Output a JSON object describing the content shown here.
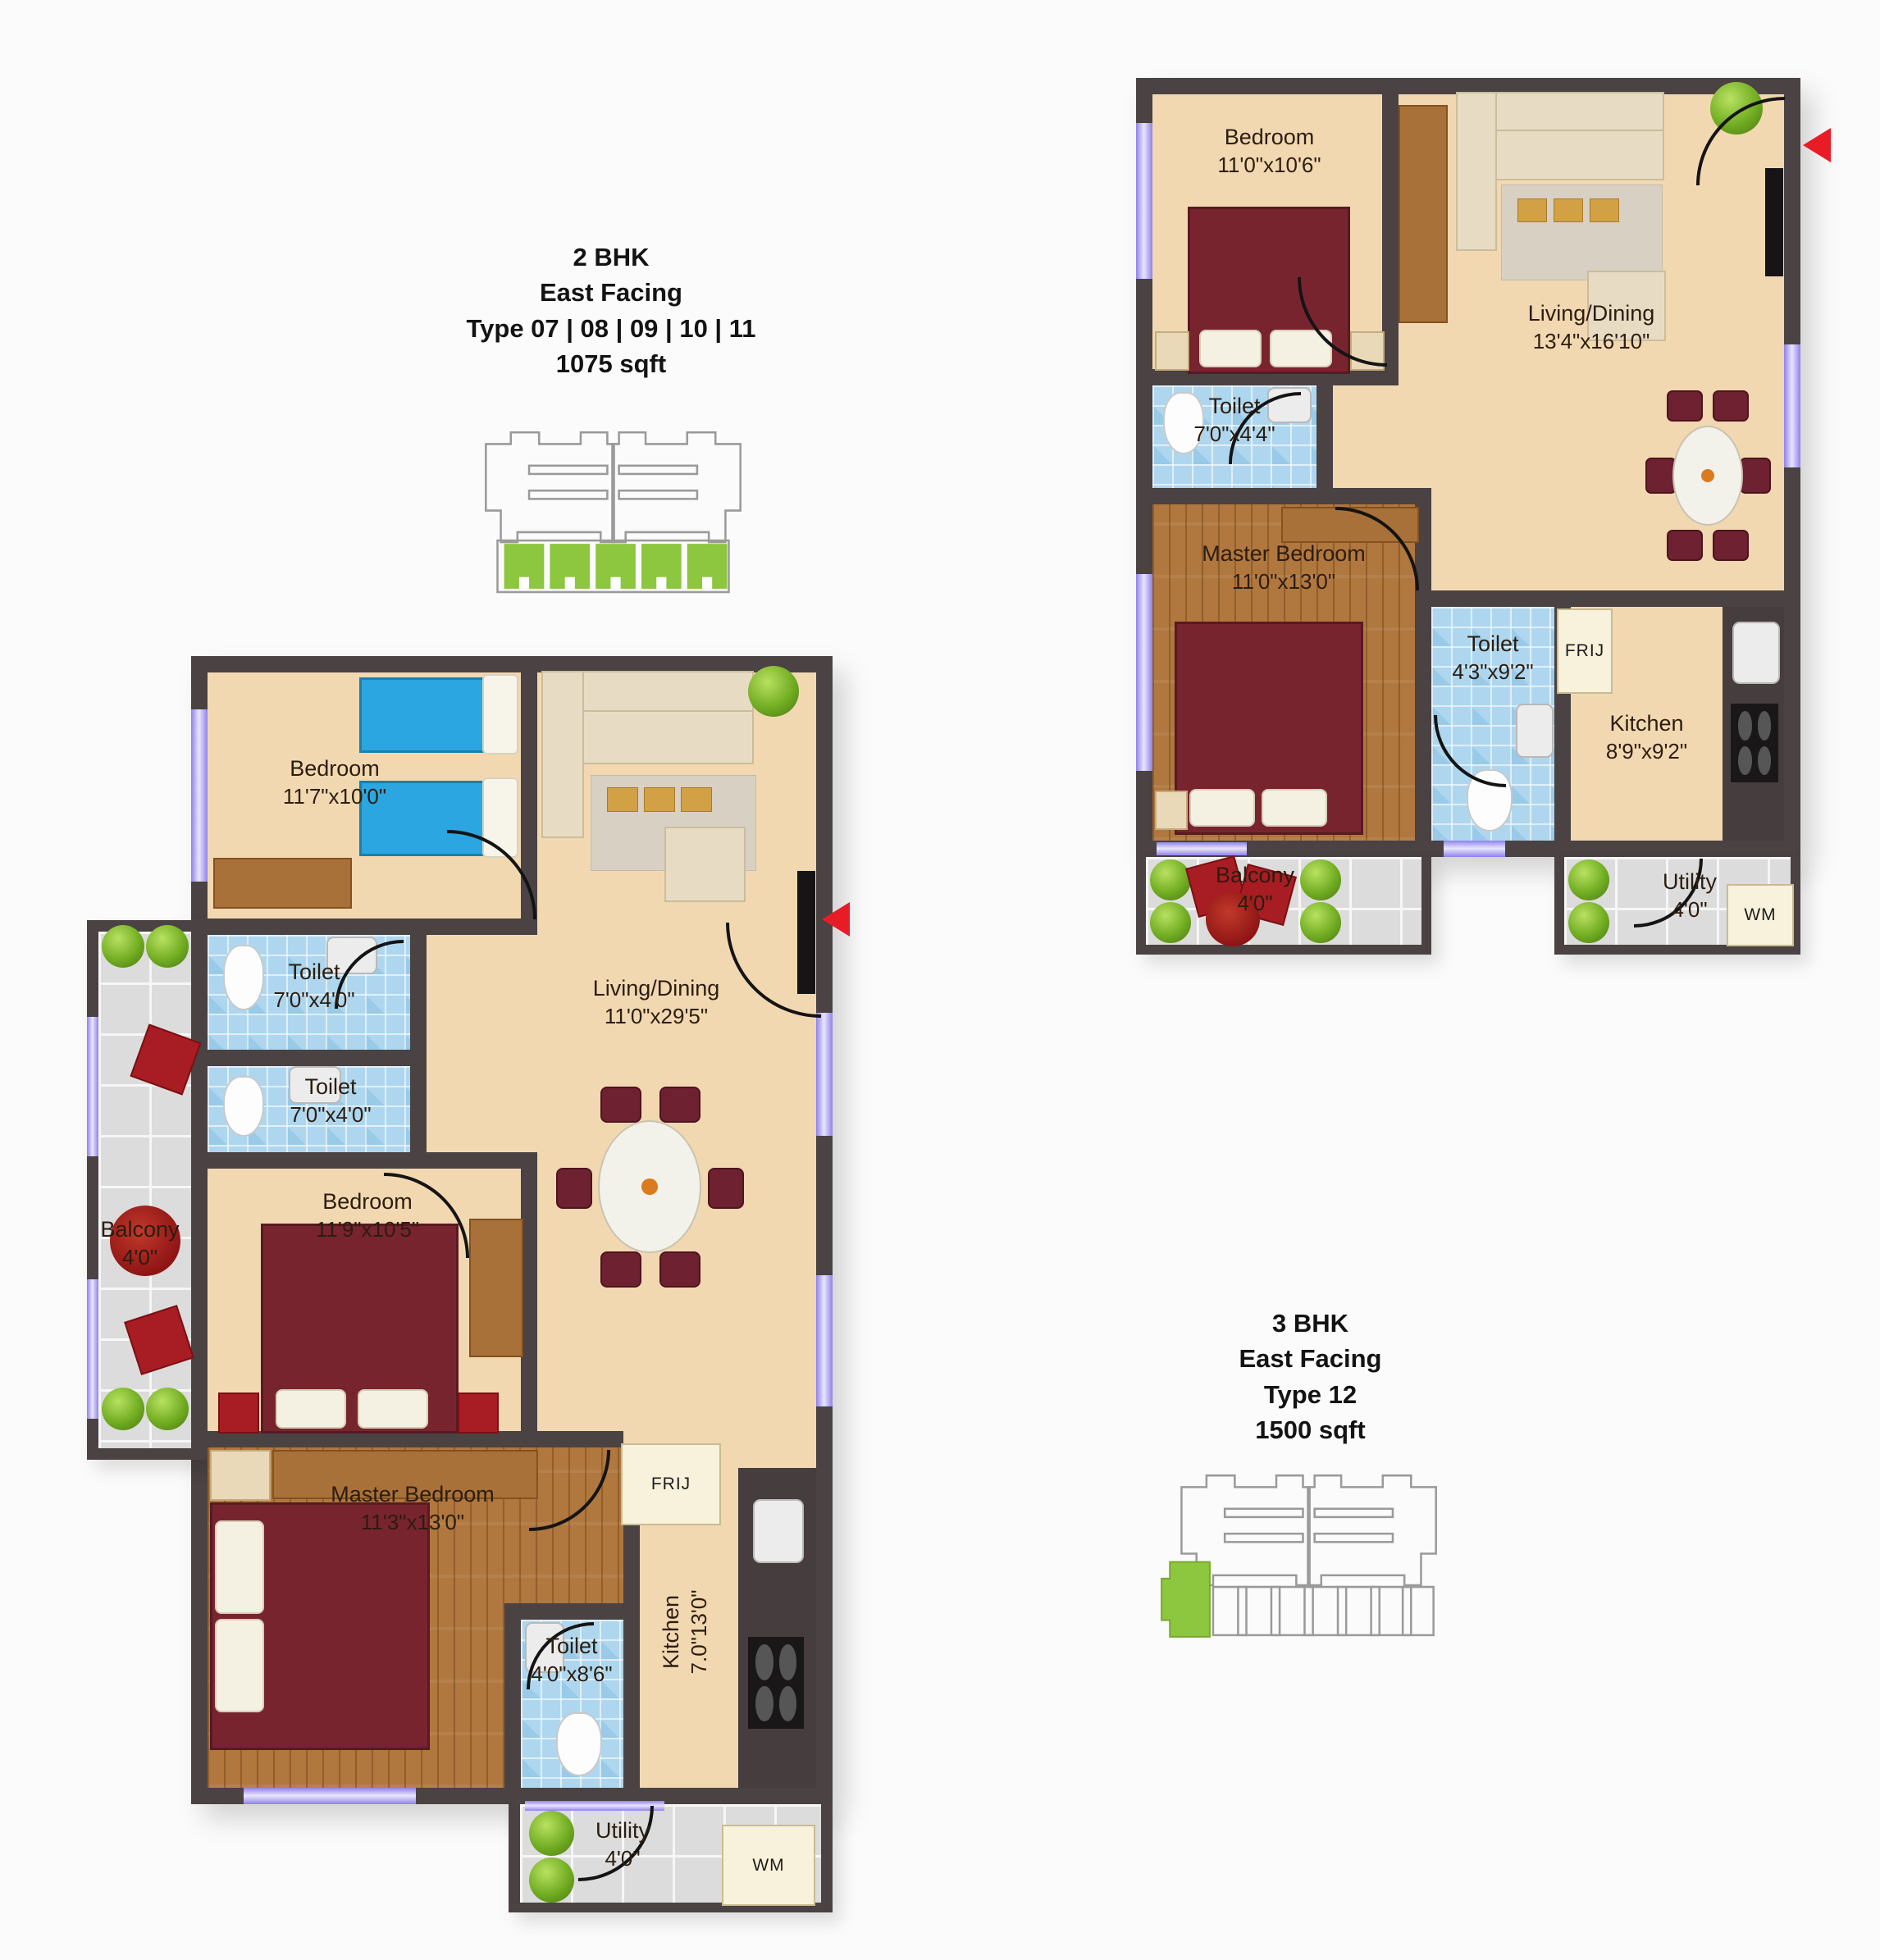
{
  "colors": {
    "wall": "#4a4243",
    "floor_cream": "#f2d8b1",
    "tile_blue": "#aed7ef",
    "wood": "#b0773e",
    "balcony_tile": "#dcdcdc",
    "keyplan_green": "#8dc63f",
    "arrow_red": "#e81c26",
    "window_lavender": "#8f82e8",
    "bed_maroon": "#78242f",
    "bed_blue": "#2ba6e0"
  },
  "left_plan": {
    "title": {
      "bhk": "2 BHK",
      "facing": "East Facing",
      "type": "Type 07 | 08 | 09 | 10 | 11",
      "area": "1075 sqft"
    },
    "rooms": {
      "bedroom1": {
        "name": "Bedroom",
        "dims": "11'7\"x10'0\""
      },
      "toilet1": {
        "name": "Toilet",
        "dims": "7'0\"x4'0\""
      },
      "toilet2": {
        "name": "Toilet",
        "dims": "7'0\"x4'0\""
      },
      "bedroom2": {
        "name": "Bedroom",
        "dims": "11'9\"x10'5\""
      },
      "balcony": {
        "name": "Balcony",
        "dims": "4'0\""
      },
      "master_bedroom": {
        "name": "Master Bedroom",
        "dims": "11'3\"x13'0\""
      },
      "toilet3": {
        "name": "Toilet",
        "dims": "4'0\"x8'6\""
      },
      "kitchen": {
        "name": "Kitchen",
        "dims": "7.0\"13'0\""
      },
      "living_dining": {
        "name": "Living/Dining",
        "dims": "11'0\"x29'5\""
      },
      "utility": {
        "name": "Utility",
        "dims": "4'0\""
      }
    },
    "appliances": {
      "fridge": "FRIJ",
      "washing_machine": "WM"
    }
  },
  "right_plan": {
    "title": {
      "bhk": "3 BHK",
      "facing": "East Facing",
      "type": "Type 12",
      "area": "1500 sqft"
    },
    "rooms": {
      "bedroom": {
        "name": "Bedroom",
        "dims": "11'0\"x10'6\""
      },
      "living_dining": {
        "name": "Living/Dining",
        "dims": "13'4\"x16'10\""
      },
      "toilet1": {
        "name": "Toilet",
        "dims": "7'0\"x4'4\""
      },
      "master_bedroom": {
        "name": "Master Bedroom",
        "dims": "11'0\"x13'0\""
      },
      "toilet2": {
        "name": "Toilet",
        "dims": "4'3\"x9'2\""
      },
      "kitchen": {
        "name": "Kitchen",
        "dims": "8'9\"x9'2\""
      },
      "balcony": {
        "name": "Balcony",
        "dims": "4'0\""
      },
      "utility": {
        "name": "Utility",
        "dims": "4'0\""
      }
    },
    "appliances": {
      "fridge": "FRIJ",
      "washing_machine": "WM"
    }
  }
}
